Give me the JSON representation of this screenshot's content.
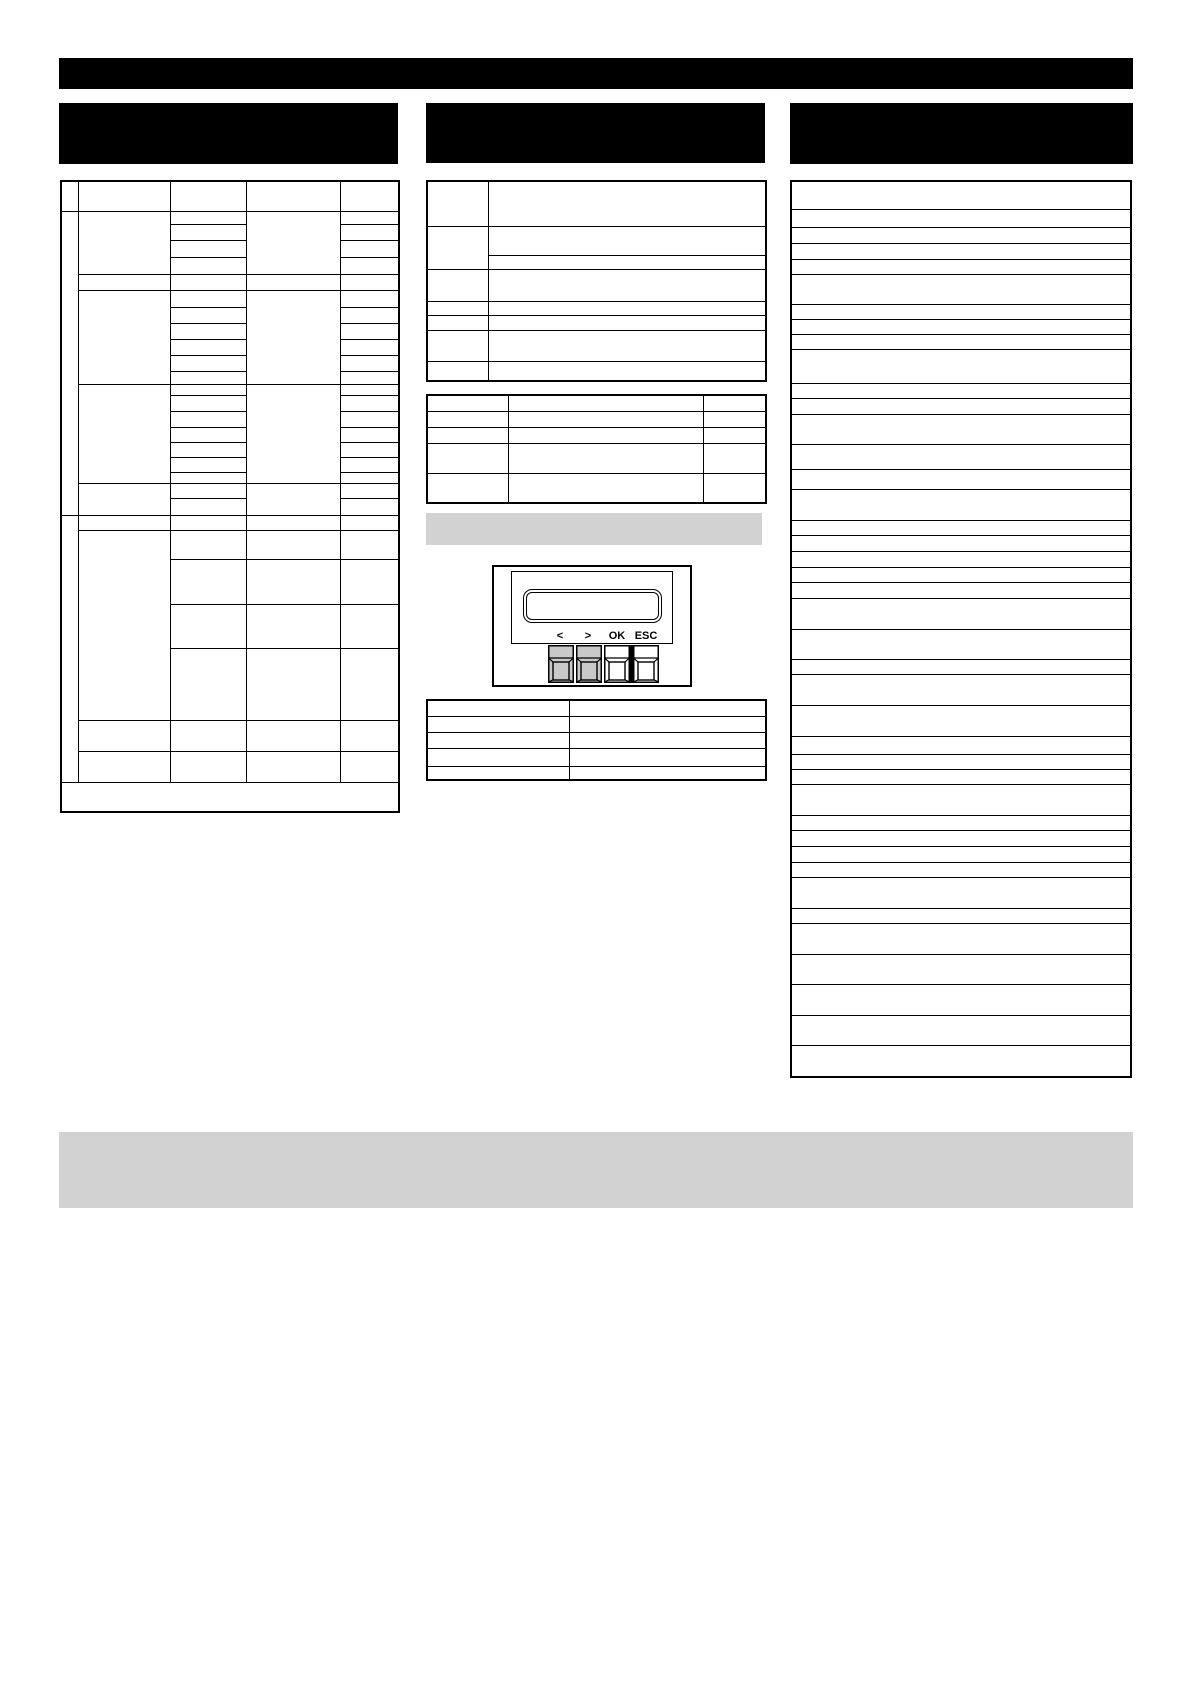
{
  "device_panel": {
    "lcd_text": "",
    "key_labels": [
      "<",
      ">",
      "OK",
      "ESC"
    ]
  },
  "colors": {
    "heading_block": "#000000",
    "table_line": "#000000",
    "middle_strip": "#d2d2d2",
    "bottom_note": "#d2d2d2",
    "key_shade": "#c9c9c9",
    "page_background": "#ffffff"
  }
}
